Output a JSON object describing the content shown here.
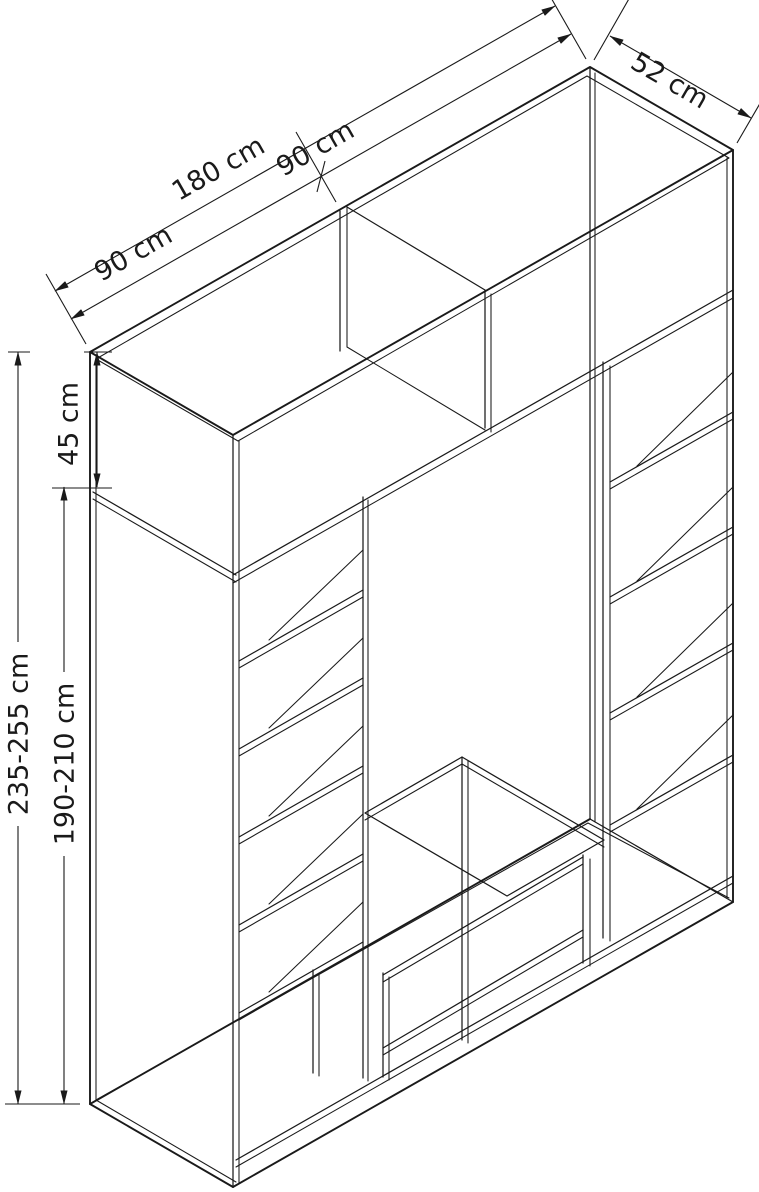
{
  "diagram": {
    "type": "furniture-technical-drawing",
    "subject": "wardrobe carcass with top cabinet, shelves and two drawers",
    "colors": {
      "background": "#ffffff",
      "line": "#1a1a1a"
    },
    "dimensions": {
      "width_total": "180 cm",
      "width_left_half": "90 cm",
      "width_right_half": "90 cm",
      "depth": "52 cm",
      "top_cabinet_height": "45 cm",
      "height_total": "235-255 cm",
      "height_main": "190-210 cm"
    }
  }
}
